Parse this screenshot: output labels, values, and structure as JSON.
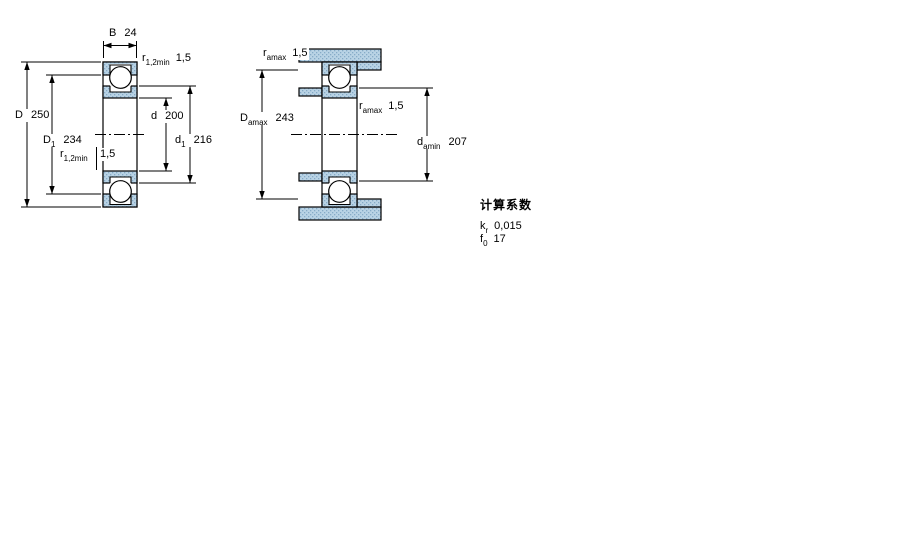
{
  "drawing": {
    "left_figure": {
      "labels": {
        "width": {
          "sym": "B",
          "val": "24"
        },
        "r_top": {
          "sym": "r",
          "sub": "1,2min",
          "val": "1,5"
        },
        "outer_dia": {
          "sym": "D",
          "val": "250"
        },
        "outer_shoulder_dia": {
          "sym": "D",
          "sub": "1",
          "val": "234"
        },
        "bore_dia": {
          "sym": "d",
          "val": "200"
        },
        "inner_shoulder_dia": {
          "sym": "d",
          "sub": "1",
          "val": "216"
        },
        "r_mid": {
          "sym": "r",
          "sub": "1,2min",
          "val": "1,5"
        }
      }
    },
    "right_figure": {
      "labels": {
        "r_top": {
          "sym": "r",
          "sub": "amax",
          "val": "1,5"
        },
        "housing_shoulder_dia": {
          "sym": "D",
          "sub": "amax",
          "val": "243"
        },
        "r_mid": {
          "sym": "r",
          "sub": "amax",
          "val": "1,5"
        },
        "shaft_shoulder_dia": {
          "sym": "d",
          "sub": "amin",
          "val": "207"
        }
      }
    },
    "calculation_factors": {
      "title": "计算系数",
      "rows": [
        {
          "sym": "k",
          "sub": "r",
          "val": "0,015"
        },
        {
          "sym": "f",
          "sub": "0",
          "val": "17"
        }
      ]
    },
    "colors": {
      "section_fill": "#b9d3e5",
      "section_dot": "#86abc7",
      "line": "#000000",
      "background": "#ffffff"
    }
  }
}
